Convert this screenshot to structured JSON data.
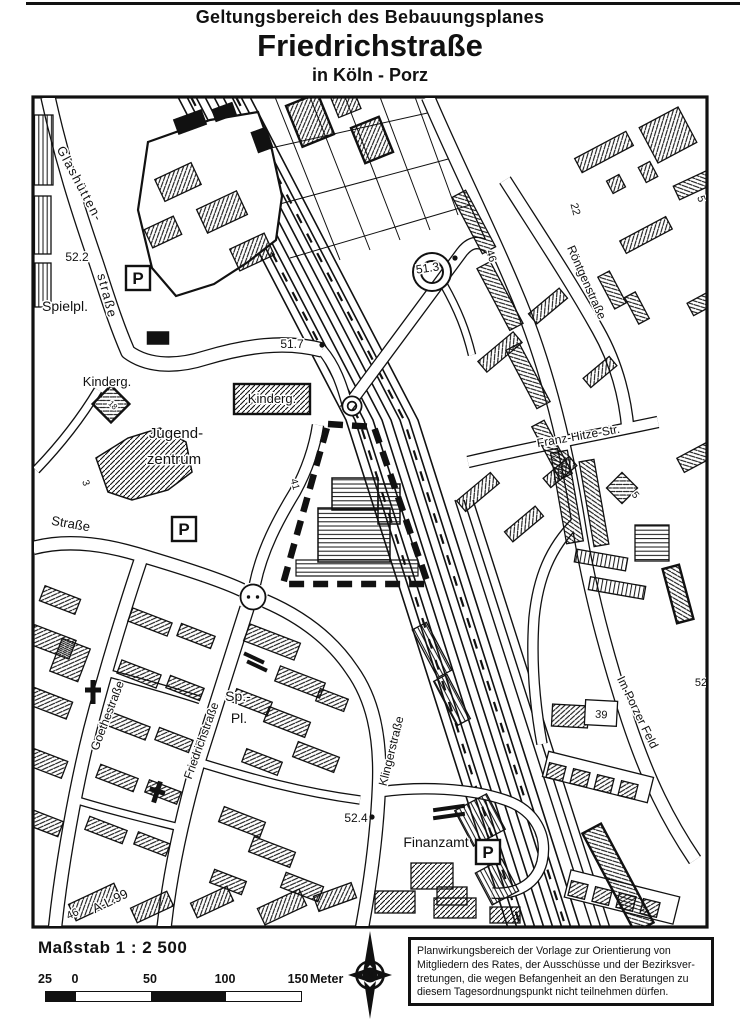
{
  "header": {
    "title_line1": "Geltungsbereich des Bebauungsplanes",
    "title_line2": "Friedrichstraße",
    "title_line3": "in Köln - Porz"
  },
  "map": {
    "parking_symbol": "P",
    "parking_boxes": [
      {
        "x": 138,
        "y": 278
      },
      {
        "x": 184,
        "y": 529
      },
      {
        "x": 488,
        "y": 852
      }
    ],
    "labels": [
      {
        "text": "Glashütten-",
        "x": 76,
        "y": 186,
        "rot": 62,
        "size": 13,
        "spacing": 1.5
      },
      {
        "text": "straße",
        "x": 103,
        "y": 297,
        "rot": 75,
        "size": 13,
        "spacing": 1.5
      },
      {
        "text": "52.2",
        "x": 77,
        "y": 261,
        "rot": 0,
        "size": 12
      },
      {
        "text": "Spielpl.",
        "x": 65,
        "y": 311,
        "rot": 0,
        "size": 14
      },
      {
        "text": "Kinderg.",
        "x": 107,
        "y": 386,
        "rot": 0,
        "size": 13
      },
      {
        "text": "18",
        "x": 111,
        "y": 407,
        "rot": 45,
        "size": 8
      },
      {
        "text": "Jugend-",
        "x": 176,
        "y": 438,
        "rot": 0,
        "size": 15
      },
      {
        "text": "zentrum",
        "x": 174,
        "y": 464,
        "rot": 0,
        "size": 15
      },
      {
        "text": "51.7",
        "x": 292,
        "y": 348,
        "rot": 0,
        "size": 12
      },
      {
        "text": "Kinderg.",
        "x": 272,
        "y": 403,
        "rot": 0,
        "size": 13
      },
      {
        "text": "51.3",
        "x": 428,
        "y": 272,
        "rot": -8,
        "size": 12
      },
      {
        "text": "46",
        "x": 488,
        "y": 257,
        "rot": 72,
        "size": 11
      },
      {
        "text": "22",
        "x": 572,
        "y": 210,
        "rot": 75,
        "size": 11
      },
      {
        "text": "Röntgenstraße",
        "x": 583,
        "y": 284,
        "rot": 66,
        "size": 12
      },
      {
        "text": "5",
        "x": 698,
        "y": 200,
        "rot": 70,
        "size": 11
      },
      {
        "text": "Franz-Hitze-Str.",
        "x": 579,
        "y": 440,
        "rot": -10,
        "size": 12
      },
      {
        "text": "5",
        "x": 633,
        "y": 497,
        "rot": 50,
        "size": 10
      },
      {
        "text": "Straße",
        "x": 70,
        "y": 528,
        "rot": 10,
        "size": 13
      },
      {
        "text": "3",
        "x": 83,
        "y": 484,
        "rot": 70,
        "size": 10
      },
      {
        "text": "41",
        "x": 292,
        "y": 485,
        "rot": 75,
        "size": 10
      },
      {
        "text": "Goethestraße",
        "x": 111,
        "y": 717,
        "rot": -69,
        "size": 12
      },
      {
        "text": "Friedrichstraße",
        "x": 205,
        "y": 742,
        "rot": -70,
        "size": 12
      },
      {
        "text": "Sp.-",
        "x": 238,
        "y": 701,
        "rot": 0,
        "size": 14
      },
      {
        "text": "Pl.",
        "x": 239,
        "y": 723,
        "rot": 0,
        "size": 14
      },
      {
        "text": "Klingerstraße",
        "x": 395,
        "y": 752,
        "rot": -76,
        "size": 12
      },
      {
        "text": "52.4",
        "x": 356,
        "y": 822,
        "rot": 0,
        "size": 12
      },
      {
        "text": "Finanzamt",
        "x": 436,
        "y": 847,
        "rot": 0,
        "size": 14
      },
      {
        "text": "Im Porzer Feld",
        "x": 634,
        "y": 714,
        "rot": 64,
        "size": 12
      },
      {
        "text": "39",
        "x": 601,
        "y": 718,
        "rot": 5,
        "size": 11
      },
      {
        "text": "52",
        "x": 701,
        "y": 686,
        "rot": 0,
        "size": 11
      },
      {
        "text": "A-L 99",
        "x": 112,
        "y": 905,
        "rot": -26,
        "size": 13
      },
      {
        "text": "46",
        "x": 74,
        "y": 917,
        "rot": -26,
        "size": 11
      }
    ]
  },
  "footer": {
    "scale_label": "Maßstab  1 : 2 500",
    "scale_ticks": [
      "25",
      "0",
      "50",
      "100",
      "150"
    ],
    "scale_unit": "Meter",
    "compass_letter": "N",
    "disclaimer": {
      "lines": [
        "Planwirkungsbereich der Vorlage zur Orientierung von",
        "Mitgliedern des Rates, der Ausschüsse und der Bezirksver-",
        "tretungen, die wegen Befangenheit an den Beratungen zu",
        "diesem Tagesordnungspunkt nicht teilnehmen dürfen."
      ]
    }
  }
}
